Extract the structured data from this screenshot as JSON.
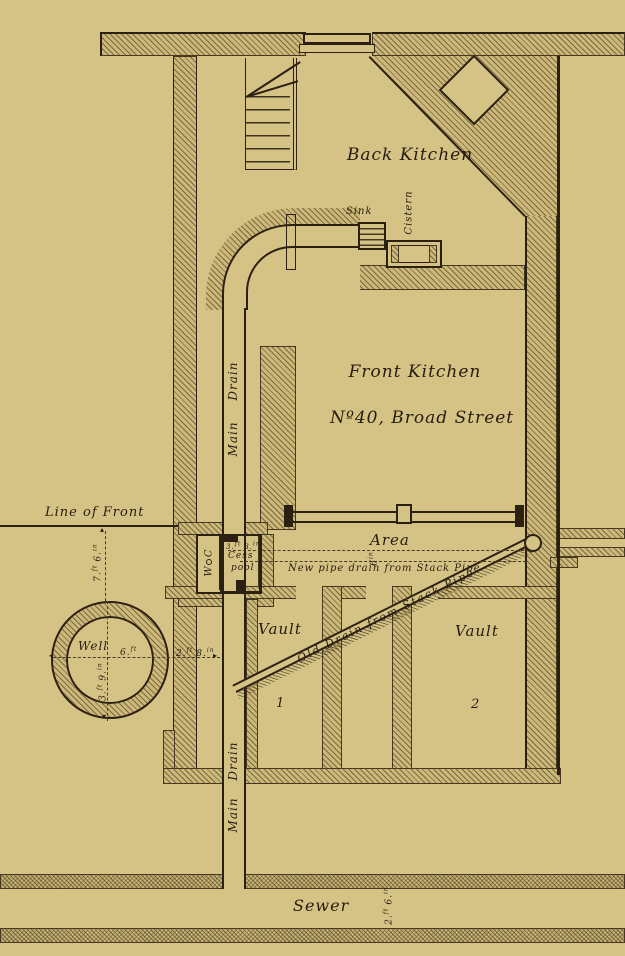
{
  "palette": {
    "paper": "#d5c386",
    "ink": "#2b2012"
  },
  "labels": {
    "back_kitchen": "Back Kitchen",
    "front_kitchen": "Front Kitchen",
    "address": "Nº40, Broad Street",
    "sink": "Sink",
    "cistern": "Cistern",
    "main_drain_upper": "Main Drain",
    "main_drain_lower": "Main Drain",
    "line_of_front": "Line of Front",
    "area": "Area",
    "new_pipe_drain": "New pipe drain from Stack Pipe",
    "old_drain": "Old Drain from Stack Pipe",
    "vault_1": "Vault",
    "vault_1_no": "1",
    "vault_2": "Vault",
    "vault_2_no": "2",
    "well": "Well",
    "wc": "W C",
    "cesspool_1": "Cess",
    "cesspool_2": "pool",
    "sewer": "Sewer"
  },
  "measurements": {
    "front_offset": {
      "v1": "7.",
      "u1": "ft",
      "v2": "6.",
      "u2": "in"
    },
    "well_to_wall": {
      "v1": "2.",
      "u1": "ft",
      "v2": "8.",
      "u2": "in"
    },
    "well_diameter": {
      "v1": "6.",
      "u1": "ft"
    },
    "well_depth": {
      "v1": "3.",
      "u1": "ft",
      "v2": "9.",
      "u2": "in"
    },
    "cesspool_size": {
      "v1": "3.",
      "u1": "ft",
      "v2": "3.",
      "u2": "in"
    },
    "new_drain_gap": {
      "v1": "6",
      "u1": "in"
    },
    "sewer_width": {
      "v1": "2.",
      "u1": "ft",
      "v2": "6.",
      "u2": "in"
    }
  },
  "icons": {
    "arrow_left": "◂",
    "arrow_right": "▸",
    "arrow_up": "▴",
    "arrow_down": "▾"
  }
}
